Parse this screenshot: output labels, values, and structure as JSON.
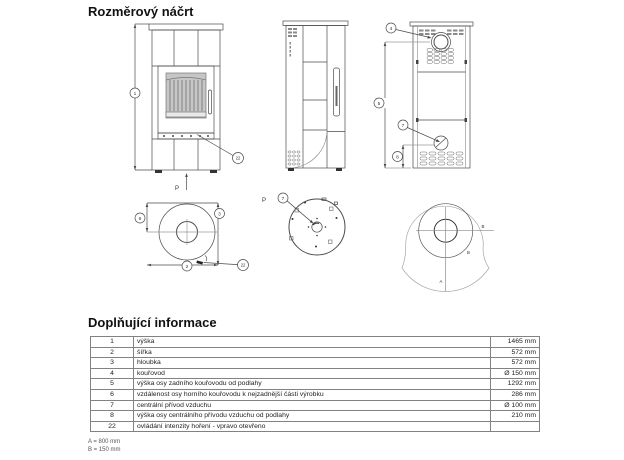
{
  "page": {
    "title": "Rozměrový náčrt"
  },
  "info": {
    "title": "Doplňující informace",
    "rows": [
      {
        "num": "1",
        "desc": "výška",
        "value": "1465 mm"
      },
      {
        "num": "2",
        "desc": "šířka",
        "value": "572 mm"
      },
      {
        "num": "3",
        "desc": "hloubka",
        "value": "572 mm"
      },
      {
        "num": "4",
        "desc": "kouřovod",
        "value": "Ø 150 mm"
      },
      {
        "num": "5",
        "desc": "výška osy zadního kouřovodu od podlahy",
        "value": "1292 mm"
      },
      {
        "num": "6",
        "desc": "vzdálenost osy horního kouřovodu k nejzadnější části výrobku",
        "value": "286 mm"
      },
      {
        "num": "7",
        "desc": "centrální přívod vzduchu",
        "value": "Ø 100 mm"
      },
      {
        "num": "8",
        "desc": "výška osy centrálního přívodu vzduchu od podlahy",
        "value": "210 mm"
      },
      {
        "num": "22",
        "desc": "ovládání intenzity hoření - vpravo otevřeno",
        "value": ""
      }
    ]
  },
  "footnotes": {
    "a": "A = 800 mm",
    "b": "B = 150 mm"
  },
  "drawing": {
    "callouts": {
      "front_height": "1",
      "front_control": "22",
      "front_p": "P",
      "back_flue": "4",
      "back_flue_height": "5",
      "back_air": "7",
      "back_air_height": "8",
      "top_flue_offset": "6",
      "top_depth": "3",
      "top_width": "2",
      "top_control": "22",
      "bottom_air": "7",
      "bottom_p": "P",
      "plate_a": "A",
      "plate_b_right": "B",
      "plate_b_arc": "B"
    },
    "line_color": "#4a4a4a",
    "light_line_color": "#9a9a9a",
    "glass_color": "#c6c6c6"
  }
}
